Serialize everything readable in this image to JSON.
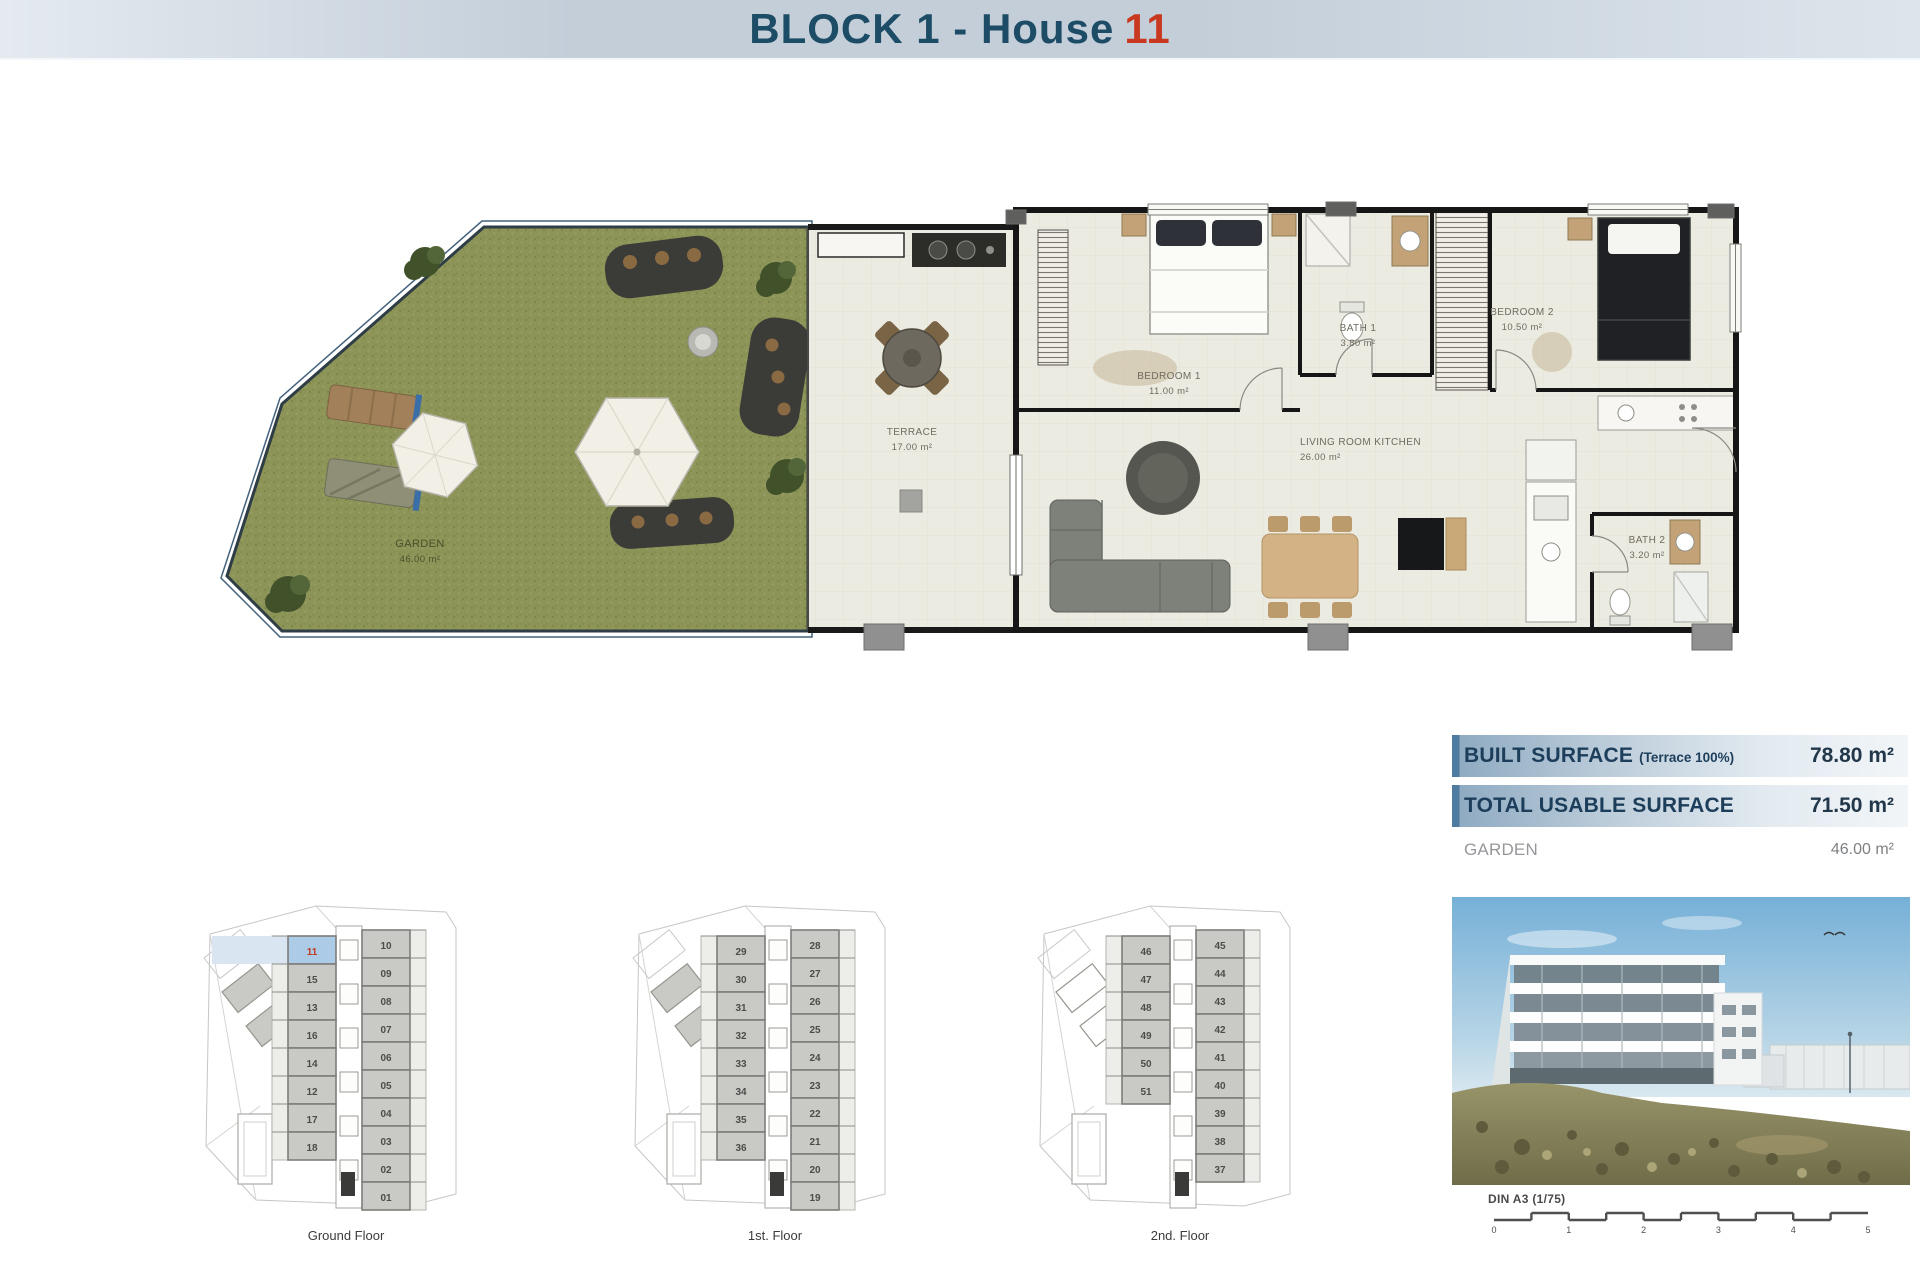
{
  "header": {
    "title": "BLOCK 1 - House",
    "house_number": "11"
  },
  "floor_plan": {
    "rooms": [
      {
        "name": "GARDEN",
        "area": "46.00 m²"
      },
      {
        "name": "TERRACE",
        "area": "17.00 m²"
      },
      {
        "name": "BEDROOM 1",
        "area": "11.00 m²"
      },
      {
        "name": "BATH 1",
        "area": "3.80 m²"
      },
      {
        "name": "BEDROOM 2",
        "area": "10.50 m²"
      },
      {
        "name": "LIVING ROOM KITCHEN",
        "area": "26.00 m²"
      },
      {
        "name": "BATH 2",
        "area": "3.20 m²"
      }
    ]
  },
  "surface_table": {
    "rows": [
      {
        "label": "BUILT SURFACE",
        "note": "(Terrace 100%)",
        "value": "78.80 m²"
      },
      {
        "label": "TOTAL USABLE SURFACE",
        "note": "",
        "value": "71.50 m²"
      },
      {
        "label": "GARDEN",
        "note": "",
        "value": "46.00 m²"
      }
    ]
  },
  "mini_plans": [
    {
      "caption": "Ground Floor",
      "highlighted_unit": "11",
      "left_units": [
        "11",
        "15",
        "13",
        "16",
        "14",
        "12",
        "17",
        "18"
      ],
      "right_units": [
        "10",
        "09",
        "08",
        "07",
        "06",
        "05",
        "04",
        "03",
        "02",
        "01"
      ]
    },
    {
      "caption": "1st. Floor",
      "highlighted_unit": "",
      "left_units": [
        "29",
        "30",
        "31",
        "32",
        "33",
        "34",
        "35",
        "36"
      ],
      "right_units": [
        "28",
        "27",
        "26",
        "25",
        "24",
        "23",
        "22",
        "21",
        "20",
        "19"
      ]
    },
    {
      "caption": "2nd. Floor",
      "highlighted_unit": "",
      "left_units": [
        "46",
        "47",
        "48",
        "49",
        "50",
        "51"
      ],
      "right_units": [
        "45",
        "44",
        "43",
        "42",
        "41",
        "40",
        "39",
        "38",
        "37"
      ]
    }
  ],
  "photo": {
    "caption": "DIN A3 (1/75)",
    "scale_ticks": [
      "0",
      "1",
      "2",
      "3",
      "4",
      "5"
    ]
  },
  "colors": {
    "accent_red": "#c8391f",
    "title_blue": "#1d4c66",
    "garden_green": "#8b9356",
    "highlight_blue": "#abcbe7"
  }
}
